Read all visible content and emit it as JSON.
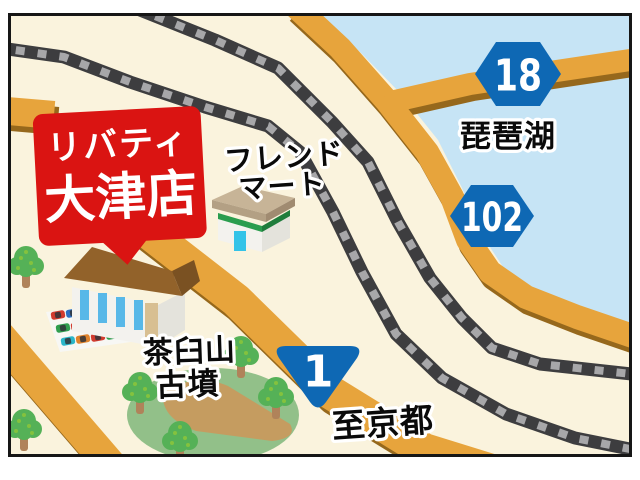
{
  "map": {
    "title_callout": {
      "line1": "リバティ",
      "line2": "大津店"
    },
    "labels": {
      "lake": "琵琶湖",
      "friend_mart_line1": "フレンド",
      "friend_mart_line2": "マート",
      "kofun_line1": "茶臼山",
      "kofun_line2": "古墳",
      "to_kyoto": "至京都"
    },
    "route_badges": [
      {
        "number": "18"
      },
      {
        "number": "102"
      },
      {
        "number": "1"
      }
    ],
    "colors": {
      "background": "#faf3dd",
      "lake": "#c6e4f5",
      "road": "#e7a43c",
      "road_shadow": "#96681c",
      "rail_dark": "#3d3d3f",
      "rail_light": "#a7a7a9",
      "badge_blue": "#0e68b4",
      "callout_red": "#da1412",
      "tree_green": "#55b157",
      "tree_dot": "#84c23e",
      "tree_trunk": "#b0835a",
      "kofun_green": "#92c089",
      "kofun_inner": "#c59c60",
      "roof_brown": "#92622a",
      "roof_brown_dark": "#7a5122",
      "wall_white": "#f3f2ee",
      "wall_shade": "#e4e3dc",
      "window_blue": "#58b8e8",
      "door_tan": "#d8bf92",
      "fm_roof": "#c7b497",
      "fm_roof_edge": "#b3a084",
      "fm_roof_dark": "#a08b71",
      "fm_green": "#2a9d4e",
      "fm_green_dark": "#1f7d3c",
      "fm_door": "#33c3e8",
      "car_red": "#d23b2f",
      "car_blue": "#2b6fc2",
      "car_green": "#2f9e4f",
      "car_orange": "#e0832c",
      "car_teal": "#2ab6c9"
    }
  }
}
